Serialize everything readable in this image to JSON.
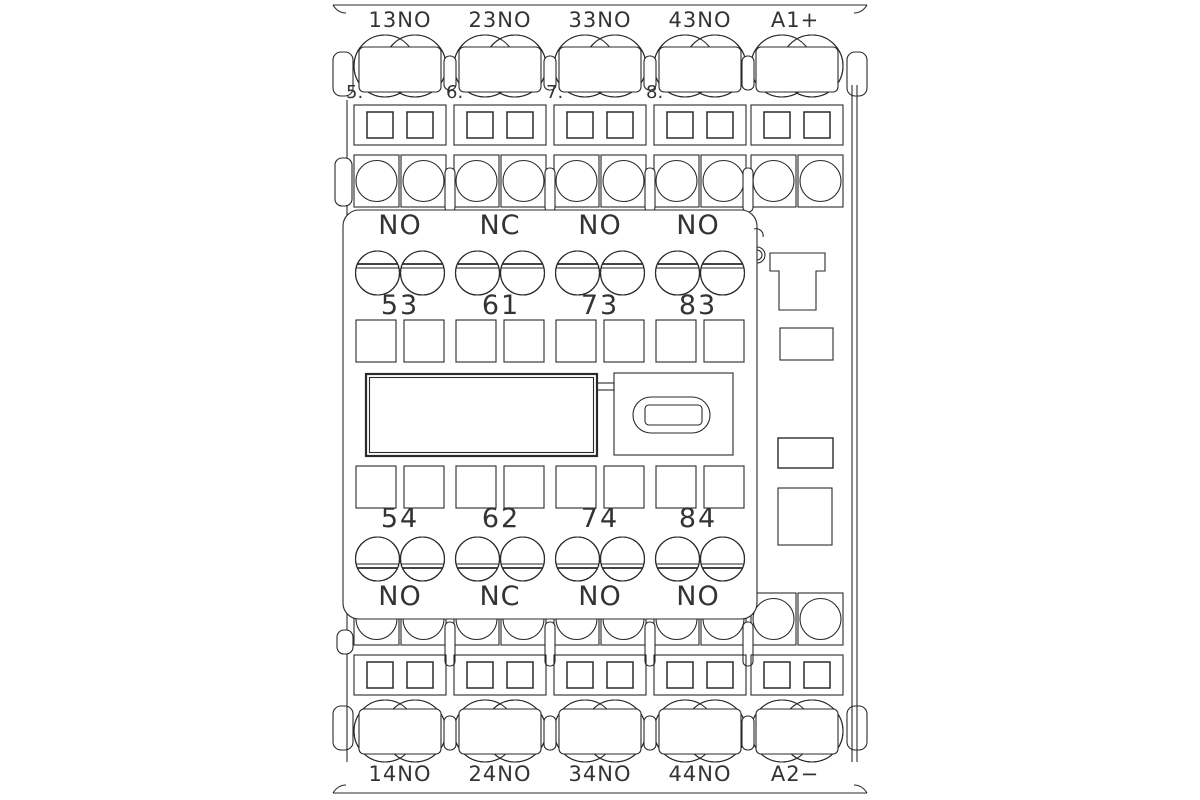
{
  "top_terminals": [
    "13NO",
    "23NO",
    "33NO",
    "43NO",
    "A1+"
  ],
  "bottom_terminals": [
    "14NO",
    "24NO",
    "34NO",
    "44NO",
    "A2−"
  ],
  "pole_numbers": [
    "5.",
    "6.",
    "7.",
    "8."
  ],
  "aux_contacts": {
    "top_types": [
      "NO",
      "NC",
      "NO",
      "NO"
    ],
    "top_terminal_numbers": [
      "53",
      "61",
      "73",
      "83"
    ],
    "bottom_terminal_numbers": [
      "54",
      "62",
      "74",
      "84"
    ],
    "bottom_types": [
      "NO",
      "NC",
      "NO",
      "NO"
    ]
  },
  "colors": {
    "line": "#2a2a2a",
    "text": "#333333",
    "background": "#ffffff"
  }
}
